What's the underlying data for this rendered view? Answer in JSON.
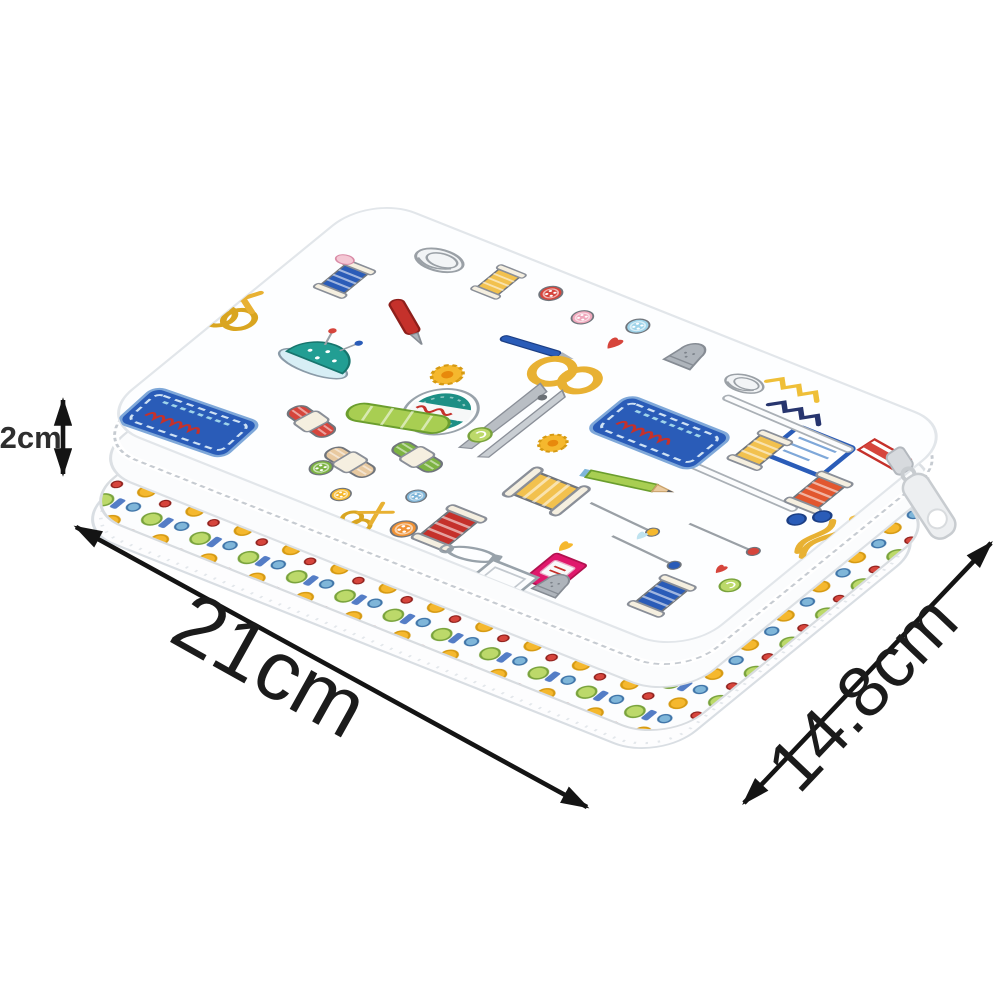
{
  "page": {
    "background_color": "#ffffff",
    "content_type": "product dimension photo",
    "subject": "Sewing kit zipper organizer case with colorful sewing-notions doodle print, shown in three-quarter top view"
  },
  "product": {
    "name": "sewing-kit-case",
    "base_color": "#fdfeff",
    "print_theme": "sewing notions doodles",
    "motifs": [
      "gold-scissors",
      "thread-spool",
      "buttons",
      "pin-cushion",
      "thread-brand-badge",
      "script-label-plaque",
      "embroidery-floss-skein",
      "sewing-pins",
      "safety-pin",
      "thimble",
      "pencil",
      "needle",
      "measuring-zigzag",
      "hearts",
      "yarn-coil",
      "zipper",
      "zipper-pull",
      "pink-thread-box",
      "flower-button"
    ],
    "accent_colors": {
      "gold": "#EFBF38",
      "red": "#C5312B",
      "blue": "#2A5CB8",
      "teal": "#1D8F85",
      "green": "#7CB342",
      "pink": "#E0186C",
      "silver": "#9AA0A6"
    }
  },
  "dimensions": {
    "width_label": "21cm",
    "depth_label": "14.8cm",
    "height_label": ".2cm",
    "arrow_color": "#141414",
    "label_color": "#1b1b1b"
  }
}
